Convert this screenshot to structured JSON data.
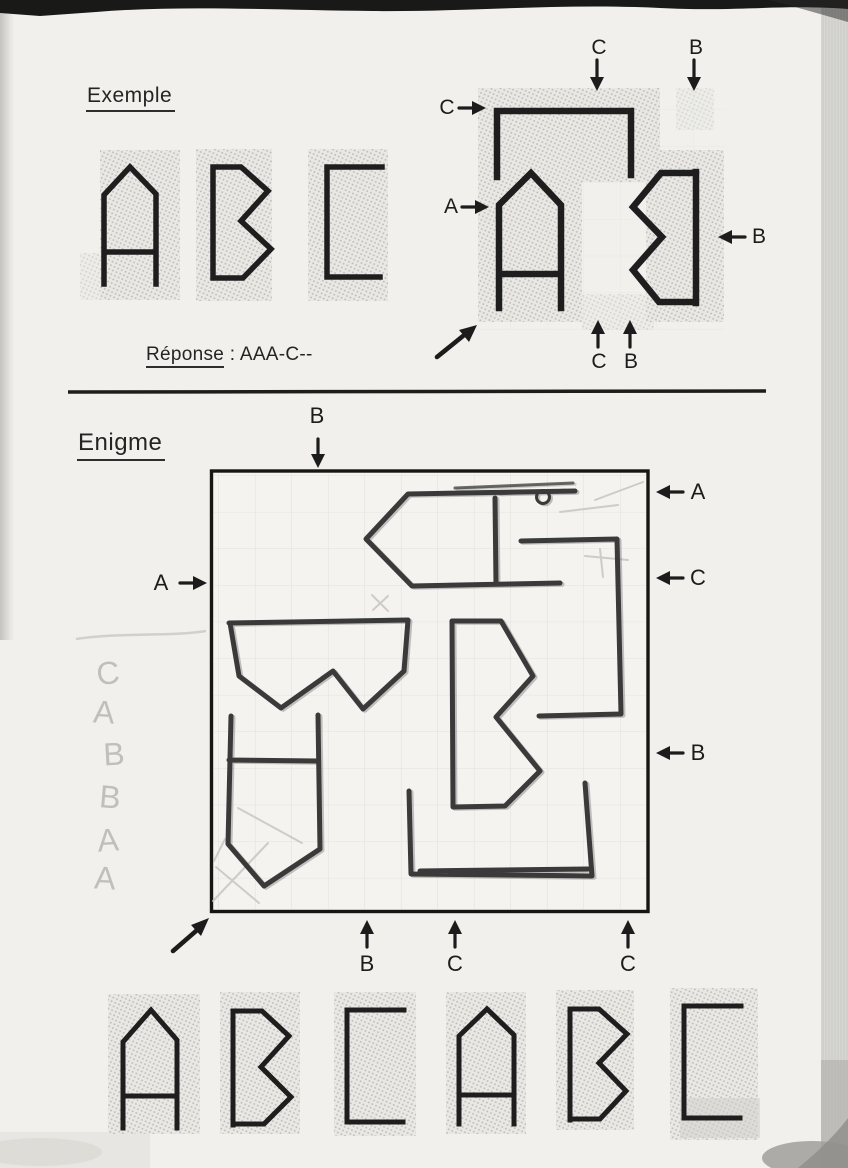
{
  "example": {
    "title": "Exemple",
    "reference_letters": [
      "A",
      "B",
      "C"
    ],
    "grid_letters": [
      "C",
      "A",
      "B"
    ],
    "grid_arrows": {
      "top_c": "C",
      "top_b": "B",
      "left_c": "C",
      "left_a": "A",
      "right_b": "B",
      "bottom_c": "C",
      "bottom_b": "B"
    },
    "answer": {
      "label": "Réponse",
      "separator": " : ",
      "value": "AAA-C--"
    }
  },
  "enigme": {
    "title": "Enigme",
    "grid_letters": [
      "A",
      "C",
      "B",
      "B",
      "A",
      "C"
    ],
    "grid_arrows": {
      "top_b": "B",
      "left_a": "A",
      "right_a": "A",
      "right_c": "C",
      "right_b": "B",
      "bottom_b": "B",
      "bottom_c1": "C",
      "bottom_c2": "C"
    },
    "pencil_notes": [
      "C",
      "A",
      "B",
      "B",
      "A",
      "A"
    ],
    "answer_letters": [
      "A",
      "B",
      "C",
      "A",
      "B",
      "C"
    ]
  }
}
